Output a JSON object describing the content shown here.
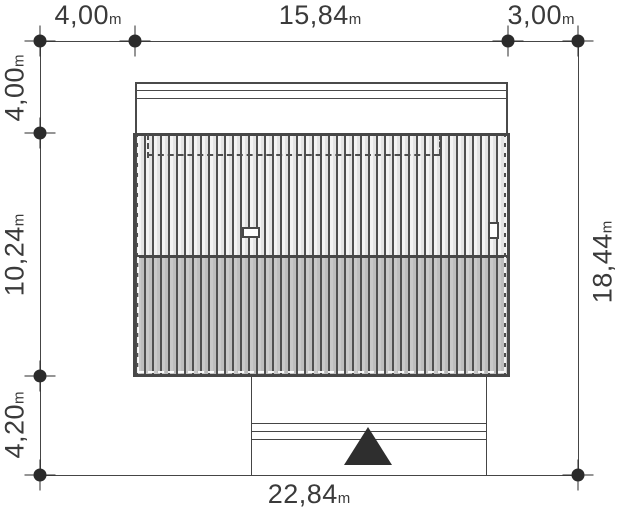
{
  "plan": {
    "unit": "m",
    "dimensions": {
      "top": [
        {
          "value": "4,00",
          "unit": "m"
        },
        {
          "value": "15,84",
          "unit": "m"
        },
        {
          "value": "3,00",
          "unit": "m"
        }
      ],
      "left": [
        {
          "value": "4,00",
          "unit": "m"
        },
        {
          "value": "10,24",
          "unit": "m"
        },
        {
          "value": "4,20",
          "unit": "m"
        }
      ],
      "right": [
        {
          "value": "18,44",
          "unit": "m"
        }
      ],
      "bottom": [
        {
          "value": "22,84",
          "unit": "m"
        }
      ]
    },
    "colors": {
      "background": "#ffffff",
      "line": "#454545",
      "text": "#3a3a3a",
      "roof_upper_slope": "#ececec",
      "roof_lower_slope": "#c3c3c3",
      "entrance_marker": "#2e2e2e"
    },
    "features": {
      "entrance_marker": "filled triangle at bottom porch",
      "chimney_count": 2,
      "roof_hatch": "vertical seams, light upper slope / shaded lower slope",
      "dashed_outline": "recessed wall outline under north roof edge"
    }
  }
}
